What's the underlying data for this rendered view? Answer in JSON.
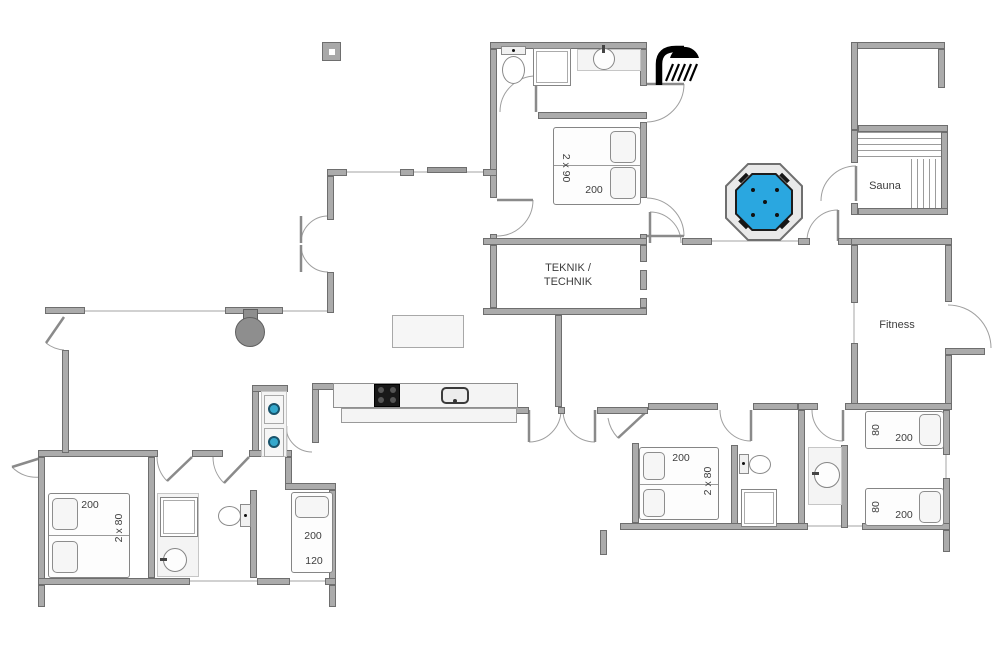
{
  "labels": {
    "teknik_line1": "TEKNIK /",
    "teknik_line2": "TECHNIK",
    "sauna": "Sauna",
    "fitness": "Fitness"
  },
  "beds": {
    "north_double": {
      "size": "2 x 90",
      "length": "200"
    },
    "west_double": {
      "size": "2 x 80",
      "length": "200"
    },
    "west_single": {
      "length": "200",
      "size": "120"
    },
    "south_double": {
      "size": "2 x 80",
      "length": "200"
    },
    "east_single_upper": {
      "size": "80",
      "length": "200"
    },
    "east_single_lower": {
      "size": "80",
      "length": "200"
    }
  },
  "icons": {
    "shower_symbol": "shower-icon",
    "hot_tub": "hot-tub-octagon",
    "fireplace": "fireplace-stove",
    "washer": "washer-dryer-stack",
    "chimney": "chimney-square",
    "sauna_benches": "sauna-bench-slats"
  },
  "colors": {
    "wall": "#ababab",
    "wall_edge": "#6e6e6e",
    "hot_tub_water": "#2aa7e0",
    "appliance_black": "#181818",
    "washer_door_blue": "#35a8cc",
    "thin_line": "#c2c2c2",
    "text": "#3d3d3d",
    "fill_light": "#f4f4f4"
  }
}
